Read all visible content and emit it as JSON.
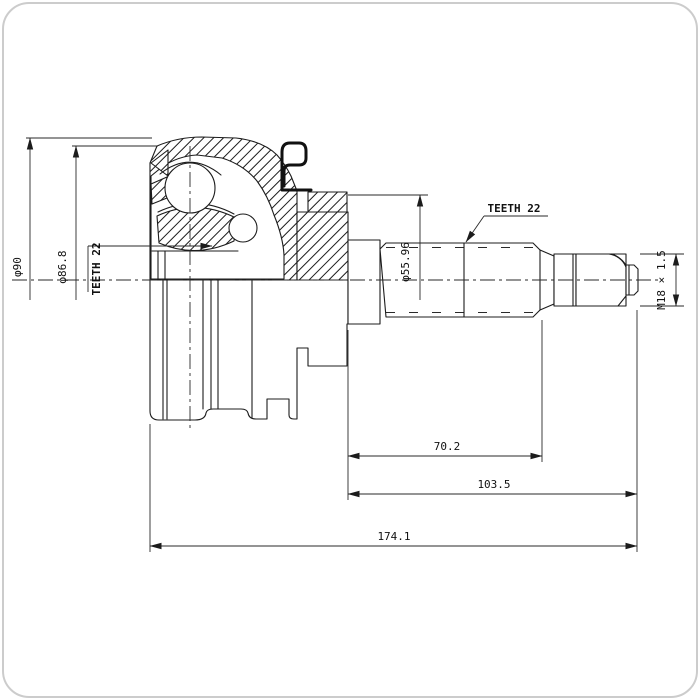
{
  "drawing": {
    "kind": "cv-joint-cross-section-technical-drawing",
    "colors": {
      "line": "#1c1c1c",
      "background": "#ffffff",
      "frame": "#cccccc"
    },
    "dimensions": {
      "outer_diameter": "φ90",
      "secondary_diameter": "φ86.8",
      "inner_spline_teeth": "TEETH 22",
      "flange_diameter": "φ55.96",
      "shaft_spline_teeth": "TEETH 22",
      "thread_spec": "M18 × 1.5",
      "spline_length": "70.2",
      "shaft_length": "103.5",
      "total_length": "174.1"
    }
  }
}
